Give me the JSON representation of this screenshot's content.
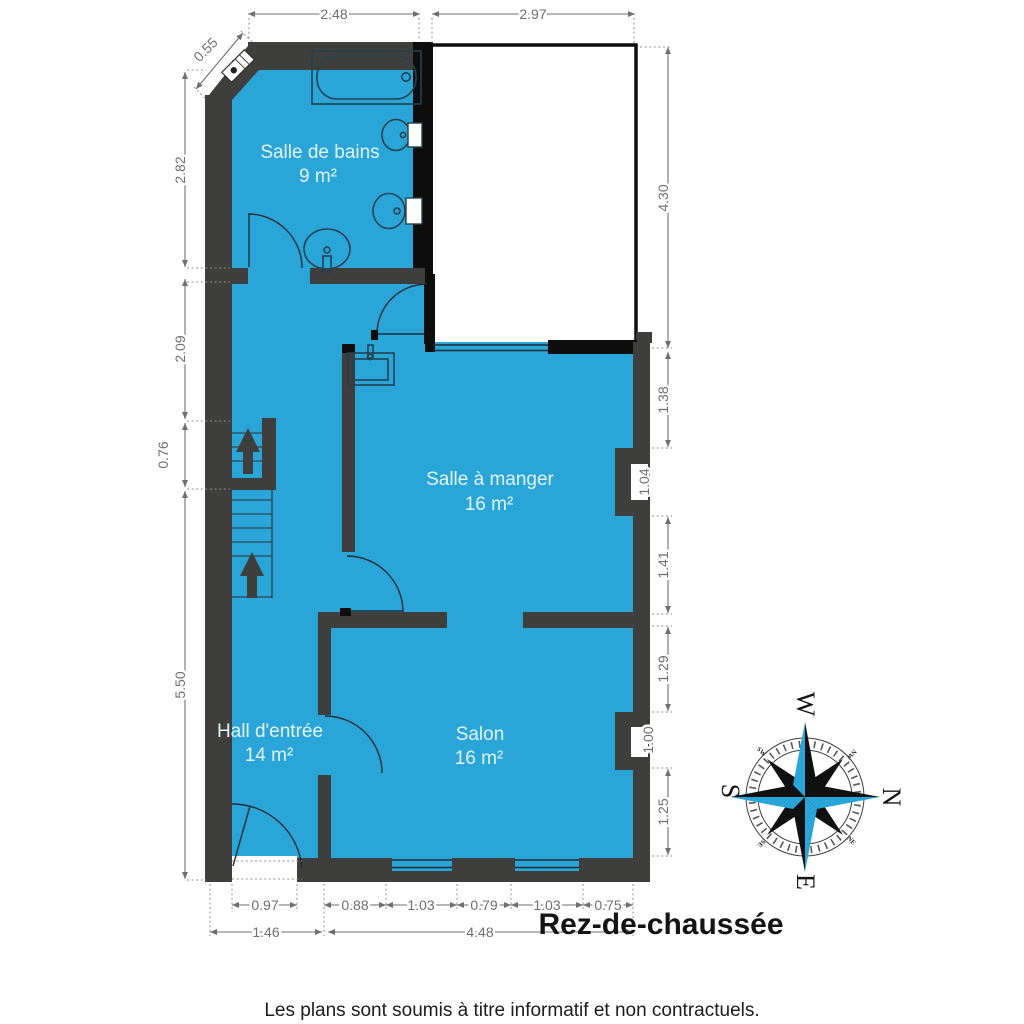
{
  "title": "Rez-de-chaussée",
  "footer": "Les plans sont soumis à titre informatif et non contractuels.",
  "rooms": [
    {
      "name": "Salle de bains",
      "area": "9 m²"
    },
    {
      "name": "Salle à manger",
      "area": "16 m²"
    },
    {
      "name": "Hall d'entrée",
      "area": "14 m²"
    },
    {
      "name": "Salon",
      "area": "16 m²"
    }
  ],
  "dims": {
    "top": [
      "2.48",
      "2.97"
    ],
    "diagonal": "0.55",
    "left": [
      "2.82",
      "2.09",
      "0.76",
      "5.50"
    ],
    "right": [
      "4.30",
      "1.38",
      "1.04",
      "1.41",
      "1.29",
      "1.00",
      "1.25"
    ],
    "bottom": [
      "0.97",
      "0.88",
      "1.03",
      "0.79",
      "1.03",
      "0.75"
    ],
    "bottom_totals": [
      "1.46",
      "4.48"
    ]
  },
  "compass": {
    "w": "W",
    "n": "N",
    "e": "E",
    "s": "S",
    "nw": "NW",
    "ne": "NE",
    "se": "SE",
    "sw": "SW"
  },
  "colors": {
    "floor_blue": "#2aa5d8",
    "wall_dark": "#3e3e3c",
    "wall_black": "#0d0d0d",
    "dim_gray": "#6f6f6f",
    "label_light": "#e4f4fc"
  }
}
